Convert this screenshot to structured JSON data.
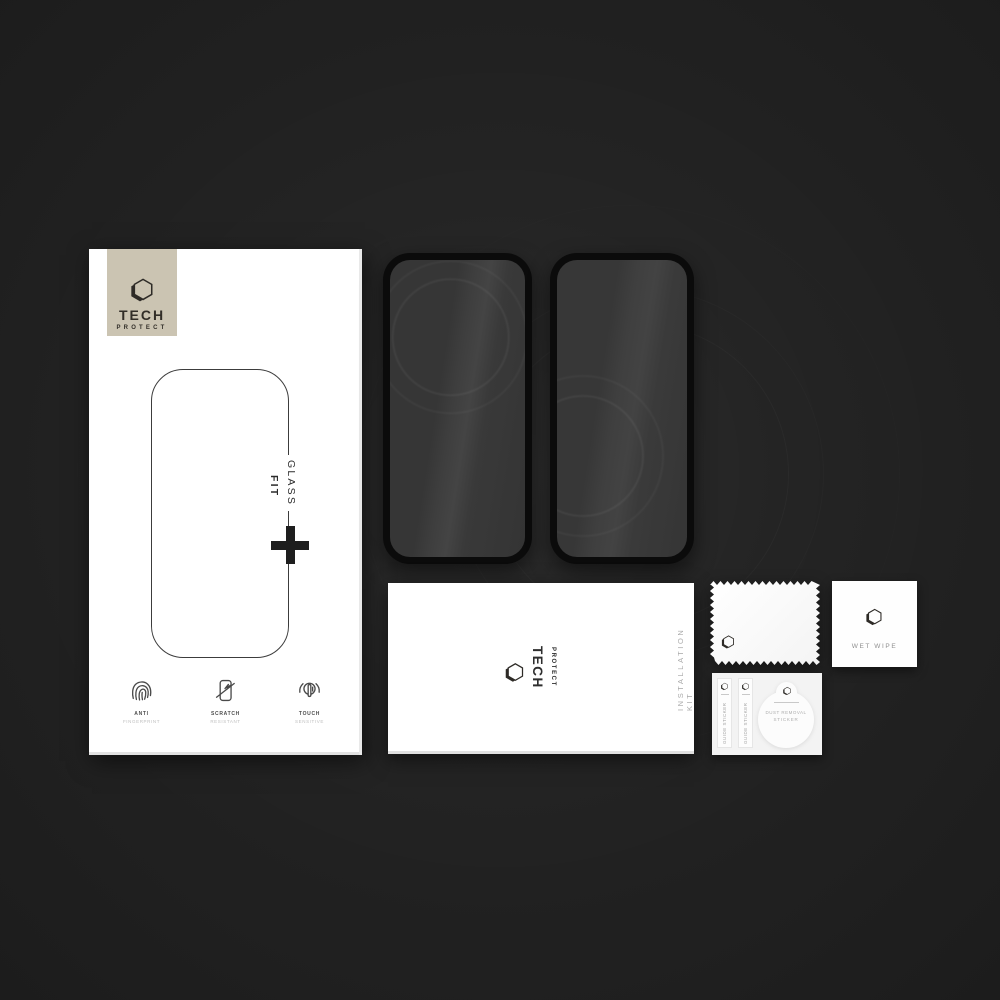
{
  "brand": {
    "name": "TECH PROTECT",
    "line1": "TECH",
    "line2": "PROTECT"
  },
  "retail_box": {
    "glass": "GLASS",
    "fit": "FIT",
    "plus": "+",
    "features": [
      {
        "icon": "fingerprint-icon",
        "line1": "ANTI",
        "line2": "FINGERPRINT"
      },
      {
        "icon": "scratch-icon",
        "line1": "SCRATCH",
        "line2": "RESISTANT"
      },
      {
        "icon": "touch-icon",
        "line1": "TOUCH",
        "line2": "SENSITIVE"
      }
    ]
  },
  "installation_kit": {
    "label": "INSTALLATION KIT"
  },
  "wet_wipe": {
    "label": "WET WIPE"
  },
  "sticker_sheet": {
    "guide_sticker_label": "GUIDE STICKER",
    "dust_sticker_line1": "DUST REMOVAL",
    "dust_sticker_line2": "STICKER"
  },
  "colors": {
    "background": "#1c1c1c",
    "box_white": "#ffffff",
    "logo_square_beige": "#cbc4b2",
    "glass_frame_black": "#0b0b0b",
    "glass_screen_gray": "#3b3b3b",
    "logo_ink": "#322e28",
    "muted_gray_text": "#a8a8a8"
  }
}
